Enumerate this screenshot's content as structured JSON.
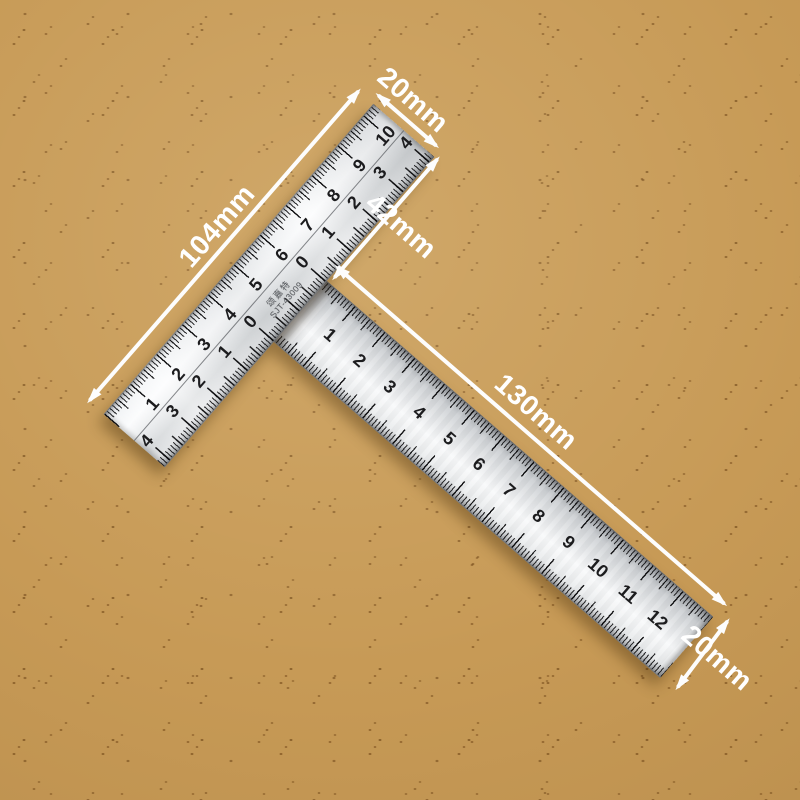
{
  "background": {
    "base_color": "#c79a56",
    "dot_color": "#764b1a"
  },
  "colors": {
    "annotation": "#ffffff",
    "metal_light": "#f9fafb",
    "metal_dark": "#9a9ea3",
    "tick": "#1c1c1e"
  },
  "tsquare": {
    "brand": {
      "name_cn": "颂嘉特",
      "model": "SJT-43009"
    },
    "crossbar": {
      "top_scale_numbers": [
        "1",
        "2",
        "3",
        "4",
        "5",
        "6",
        "7",
        "8",
        "9",
        "10"
      ],
      "inner_left_numbers": [
        "4",
        "3",
        "2",
        "1",
        "0"
      ],
      "inner_right_numbers": [
        "0",
        "1",
        "2",
        "3",
        "4"
      ]
    },
    "arm": {
      "scale_numbers": [
        "1",
        "2",
        "3",
        "4",
        "5",
        "6",
        "7",
        "8",
        "9",
        "10",
        "11",
        "12"
      ]
    }
  },
  "annotations": {
    "crossbar_width": "20mm",
    "crossbar_length": "104mm",
    "right_offset": "42mm",
    "arm_length": "130mm",
    "arm_width": "20mm"
  }
}
